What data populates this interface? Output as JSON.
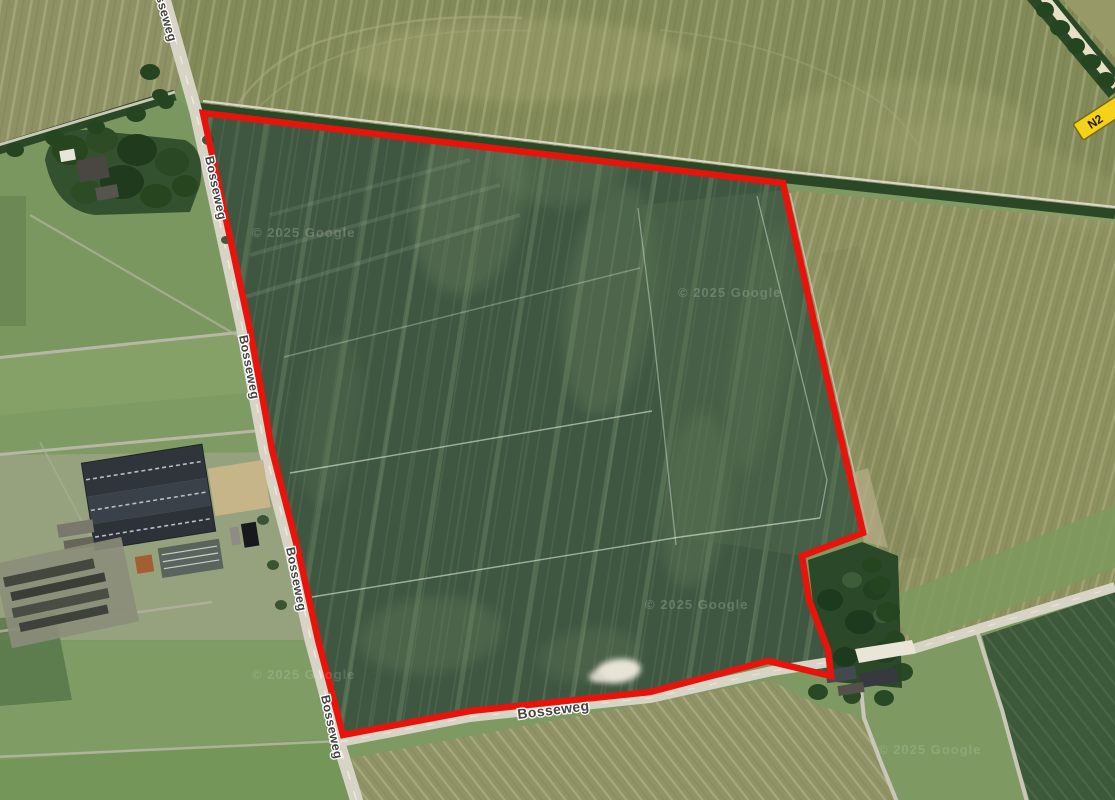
{
  "map": {
    "road_label": "Bosseweg",
    "route_shield_label": "N2",
    "attribution": "© 2025 Google",
    "colors": {
      "parcel_outline": "#e8140b",
      "shield_background": "#f5d21a",
      "road_fill": "#d7d3c5",
      "parcel_field_green": "#3f5741",
      "field_olive": "#828a58",
      "field_tan": "#8d905f"
    }
  }
}
